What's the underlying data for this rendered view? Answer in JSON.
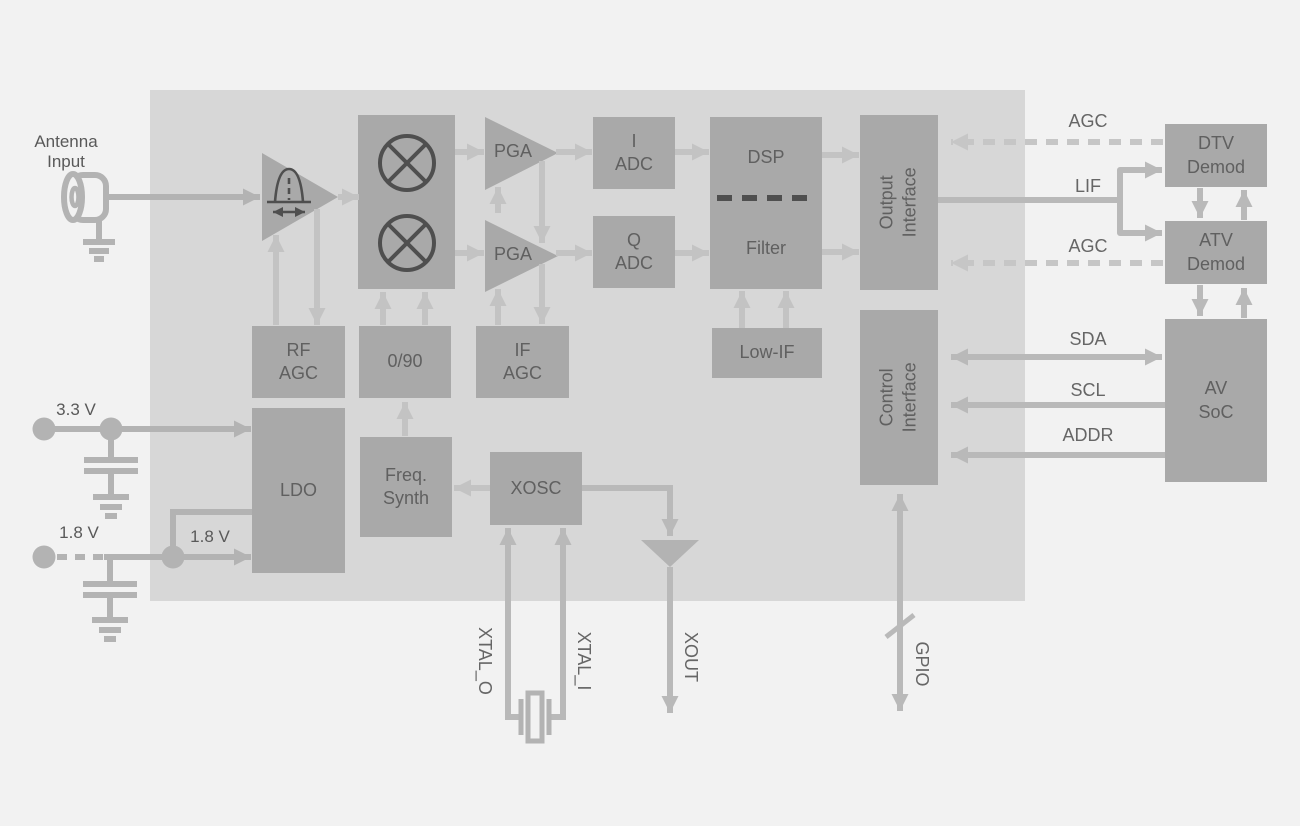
{
  "diagram": {
    "title_hint": "TV tuner chip block diagram",
    "blocks": {
      "mixer": "",
      "rf_agc": "RF\nAGC",
      "zero_90": "0/90",
      "if_agc": "IF\nAGC",
      "pga_top": "PGA",
      "pga_bottom": "PGA",
      "i_adc": "I\nADC",
      "q_adc": "Q\nADC",
      "dsp": "DSP",
      "filter": "Filter",
      "low_if": "Low-IF",
      "output_interface": "Output\nInterface",
      "control_interface": "Control\nInterface",
      "ldo": "LDO",
      "freq_synth": "Freq.\nSynth",
      "xosc": "XOSC",
      "dtv_demod": "DTV\nDemod",
      "atv_demod": "ATV\nDemod",
      "av_soc": "AV\nSoC"
    },
    "labels": {
      "antenna_input": "Antenna\nInput",
      "v33": "3.3 V",
      "v18_external": "1.8 V",
      "v18_internal": "1.8 V",
      "agc_top": "AGC",
      "lif": "LIF",
      "agc_bottom": "AGC",
      "sda": "SDA",
      "scl": "SCL",
      "addr": "ADDR",
      "xtal_o": "XTAL_O",
      "xtal_i": "XTAL_I",
      "xout": "XOUT",
      "gpio": "GPIO"
    },
    "icons": [
      "antenna-coax-connector-icon",
      "ground-icon",
      "capacitor-icon",
      "mixer-icon",
      "lna-tunable-filter-icon",
      "amplifier-triangle-icon",
      "crystal-icon",
      "bus-slash-icon"
    ],
    "colors": {
      "page_bg": "#f2f2f2",
      "chip_bg": "#d7d7d7",
      "block_fill": "#a9a9a9",
      "wire_inside": "#c3c3c3",
      "wire_outside": "#b9b9b9",
      "wire_dashed": "#c6c6c6",
      "symbol_gray": "#b3b3b3",
      "dark_stroke": "#4f4f4f",
      "text": "#666666"
    }
  }
}
